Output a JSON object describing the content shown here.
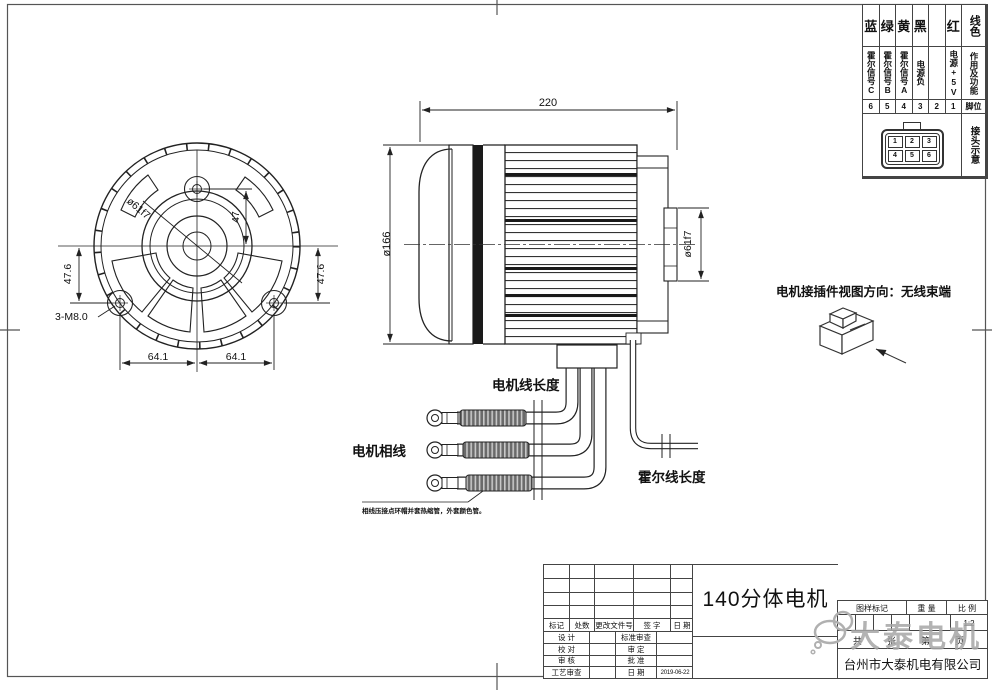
{
  "wire_table": {
    "header_color": "线色",
    "header_function": "作用及功能",
    "header_pin": "脚位",
    "header_connector": "接头示意",
    "columns": [
      {
        "color": "蓝",
        "function": "霍尔信号C",
        "pin": "6"
      },
      {
        "color": "绿",
        "function": "霍尔信号B",
        "pin": "5"
      },
      {
        "color": "黄",
        "function": "霍尔信号A",
        "pin": "4"
      },
      {
        "color": "黑",
        "function": "电源负",
        "pin": "3"
      },
      {
        "color": "",
        "function": "",
        "pin": "2"
      },
      {
        "color": "红",
        "function": "电源+5V",
        "pin": "1"
      }
    ],
    "connector_pins": [
      "1",
      "2",
      "3",
      "4",
      "5",
      "6"
    ]
  },
  "front_view": {
    "dim_top_hole": "47",
    "dim_left": "47.6",
    "dim_right": "47.6",
    "dim_bottom_left": "64.1",
    "dim_bottom_right": "64.1",
    "thread_note": "3-M8.0",
    "spigot_dia": "ø61f7"
  },
  "side_view": {
    "length": "220",
    "body_dia": "ø166",
    "spigot_dia": "ø61f7"
  },
  "harness": {
    "motor_wire_length_label": "电机线长度",
    "phase_wires_label": "电机相线",
    "hall_wire_length_label": "霍尔线长度",
    "phase_note": "相线压接点环帽并套热缩管，外套颜色管。",
    "hall_connector_pins": [
      "1",
      "2",
      "3",
      "4",
      "5",
      "6"
    ]
  },
  "connector_view": {
    "caption": "电机接插件视图方向：无线束端"
  },
  "title_block": {
    "title": "140分体电机",
    "rev_headers": {
      "mark": "标记",
      "count": "处数",
      "doc_no": "更改文件号",
      "sign": "签 字",
      "date": "日 期"
    },
    "rows": [
      {
        "left": "设 计",
        "right": "标准审查",
        "value": ""
      },
      {
        "left": "校 对",
        "right": "审 定",
        "value": ""
      },
      {
        "left": "审 核",
        "right": "批 准",
        "value": ""
      },
      {
        "left": "工艺审查",
        "right": "日 期",
        "value": "2019-06-22"
      }
    ],
    "stamp_header": "图样标记",
    "weight_header": "重 量",
    "scale_header": "比 例",
    "scale_value": "1:2",
    "sheet_row": "共　张　第　页",
    "company": "台州市大泰机电有限公司"
  },
  "watermark": {
    "text": "大泰电机",
    "color": "#a6a6a6"
  }
}
